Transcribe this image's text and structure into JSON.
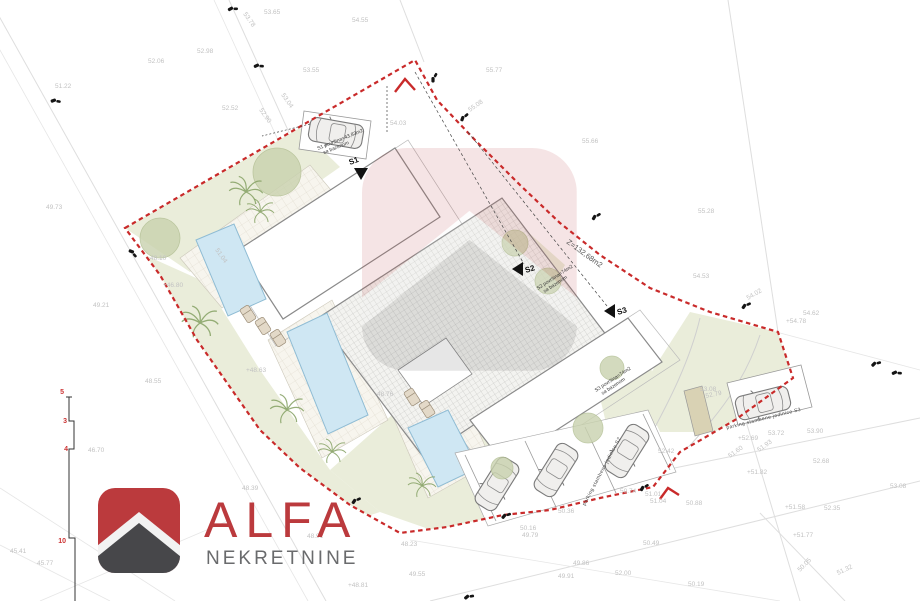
{
  "branding": {
    "name": "ALFA",
    "subtitle": "NEKRETNINE",
    "red": "#bb3a3d",
    "dark": "#47474a",
    "gray": "#6a6b6d"
  },
  "plan": {
    "area_label": "Z=132,68m2",
    "colors": {
      "boundary": "#c92a2a",
      "lawn": "#eaedda",
      "pool": "#cfe7f3",
      "canopy": "#c9d2ae",
      "elevation_text": "#c2c2c2",
      "section_red": "#cc3333"
    },
    "units": [
      {
        "id": "S1",
        "note": "S1 površina=43,83m2",
        "note2": "sa bazenom"
      },
      {
        "id": "S2",
        "note": "S2 površina=74m2",
        "note2": "sa bazenom"
      },
      {
        "id": "S3",
        "note": "S3 površina=74m2",
        "note2": "sa bazenom"
      }
    ],
    "parking_labels": [
      "parking stambene jedinice S2",
      "parking stambene jedinice S3"
    ],
    "section_marks": [
      "5",
      "3",
      "4",
      "10"
    ],
    "elevations": [
      {
        "t": "53.78",
        "x": 243,
        "y": 14,
        "r": 55
      },
      {
        "t": "53.65",
        "x": 264,
        "y": 14
      },
      {
        "t": "54.55",
        "x": 352,
        "y": 22
      },
      {
        "t": "52.06",
        "x": 148,
        "y": 63
      },
      {
        "t": "52.98",
        "x": 197,
        "y": 53
      },
      {
        "t": "55.77",
        "x": 486,
        "y": 72
      },
      {
        "t": "51.22",
        "x": 55,
        "y": 88
      },
      {
        "t": "53.55",
        "x": 303,
        "y": 72
      },
      {
        "t": "53.04",
        "x": 281,
        "y": 95,
        "r": 55
      },
      {
        "t": "52.90",
        "x": 259,
        "y": 110,
        "r": 55
      },
      {
        "t": "52.52",
        "x": 222,
        "y": 110
      },
      {
        "t": "55.08",
        "x": 470,
        "y": 112,
        "r": -35
      },
      {
        "t": "55.66",
        "x": 582,
        "y": 143
      },
      {
        "t": "55.28",
        "x": 698,
        "y": 213
      },
      {
        "t": "54.03",
        "x": 390,
        "y": 125
      },
      {
        "t": "49.73",
        "x": 46,
        "y": 209
      },
      {
        "t": "49.21",
        "x": 93,
        "y": 307
      },
      {
        "t": "48.10",
        "x": 150,
        "y": 260
      },
      {
        "t": "+46.80",
        "x": 163,
        "y": 287
      },
      {
        "t": "48.55",
        "x": 145,
        "y": 383
      },
      {
        "t": "51.04",
        "x": 215,
        "y": 250,
        "r": 55
      },
      {
        "t": "+48.63",
        "x": 246,
        "y": 372
      },
      {
        "t": "48.76",
        "x": 377,
        "y": 396
      },
      {
        "t": "54.53",
        "x": 693,
        "y": 278
      },
      {
        "t": "54.02",
        "x": 748,
        "y": 300,
        "r": -30
      },
      {
        "t": "54.62",
        "x": 803,
        "y": 315
      },
      {
        "t": "+54.78",
        "x": 786,
        "y": 323
      },
      {
        "t": "53.08",
        "x": 700,
        "y": 391
      },
      {
        "t": "52.79",
        "x": 706,
        "y": 398,
        "r": -12
      },
      {
        "t": "52.42",
        "x": 658,
        "y": 453
      },
      {
        "t": "53.90",
        "x": 807,
        "y": 433
      },
      {
        "t": "53.72",
        "x": 768,
        "y": 435
      },
      {
        "t": "+52.69",
        "x": 738,
        "y": 440
      },
      {
        "t": "51.93",
        "x": 759,
        "y": 452,
        "r": -35
      },
      {
        "t": "51.60",
        "x": 730,
        "y": 458,
        "r": -35
      },
      {
        "t": "52.68",
        "x": 813,
        "y": 463
      },
      {
        "t": "+51.82",
        "x": 747,
        "y": 474
      },
      {
        "t": "+51.58",
        "x": 785,
        "y": 509
      },
      {
        "t": "52.35",
        "x": 824,
        "y": 510
      },
      {
        "t": "53.08",
        "x": 890,
        "y": 488
      },
      {
        "t": "+51.77",
        "x": 793,
        "y": 537
      },
      {
        "t": "50.05",
        "x": 800,
        "y": 572,
        "r": -45
      },
      {
        "t": "51.32",
        "x": 838,
        "y": 575,
        "r": -25
      },
      {
        "t": "50.74",
        "x": 620,
        "y": 493
      },
      {
        "t": "51.01",
        "x": 645,
        "y": 496
      },
      {
        "t": "51.04",
        "x": 650,
        "y": 503
      },
      {
        "t": "50.88",
        "x": 686,
        "y": 505
      },
      {
        "t": "50.36",
        "x": 558,
        "y": 513
      },
      {
        "t": "50.16",
        "x": 520,
        "y": 530
      },
      {
        "t": "49.79",
        "x": 522,
        "y": 537
      },
      {
        "t": "50.49",
        "x": 643,
        "y": 545
      },
      {
        "t": "49.86",
        "x": 573,
        "y": 565
      },
      {
        "t": "49.91",
        "x": 558,
        "y": 578
      },
      {
        "t": "52.00",
        "x": 615,
        "y": 575
      },
      {
        "t": "48.23",
        "x": 401,
        "y": 546
      },
      {
        "t": "49.55",
        "x": 409,
        "y": 576
      },
      {
        "t": "50.19",
        "x": 688,
        "y": 586
      },
      {
        "t": "46.70",
        "x": 88,
        "y": 452
      },
      {
        "t": "48.39",
        "x": 242,
        "y": 490
      },
      {
        "t": "48.91",
        "x": 307,
        "y": 538
      },
      {
        "t": "+48.81",
        "x": 348,
        "y": 587
      },
      {
        "t": "45.41",
        "x": 10,
        "y": 553
      },
      {
        "t": "45.77",
        "x": 37,
        "y": 565
      }
    ]
  }
}
